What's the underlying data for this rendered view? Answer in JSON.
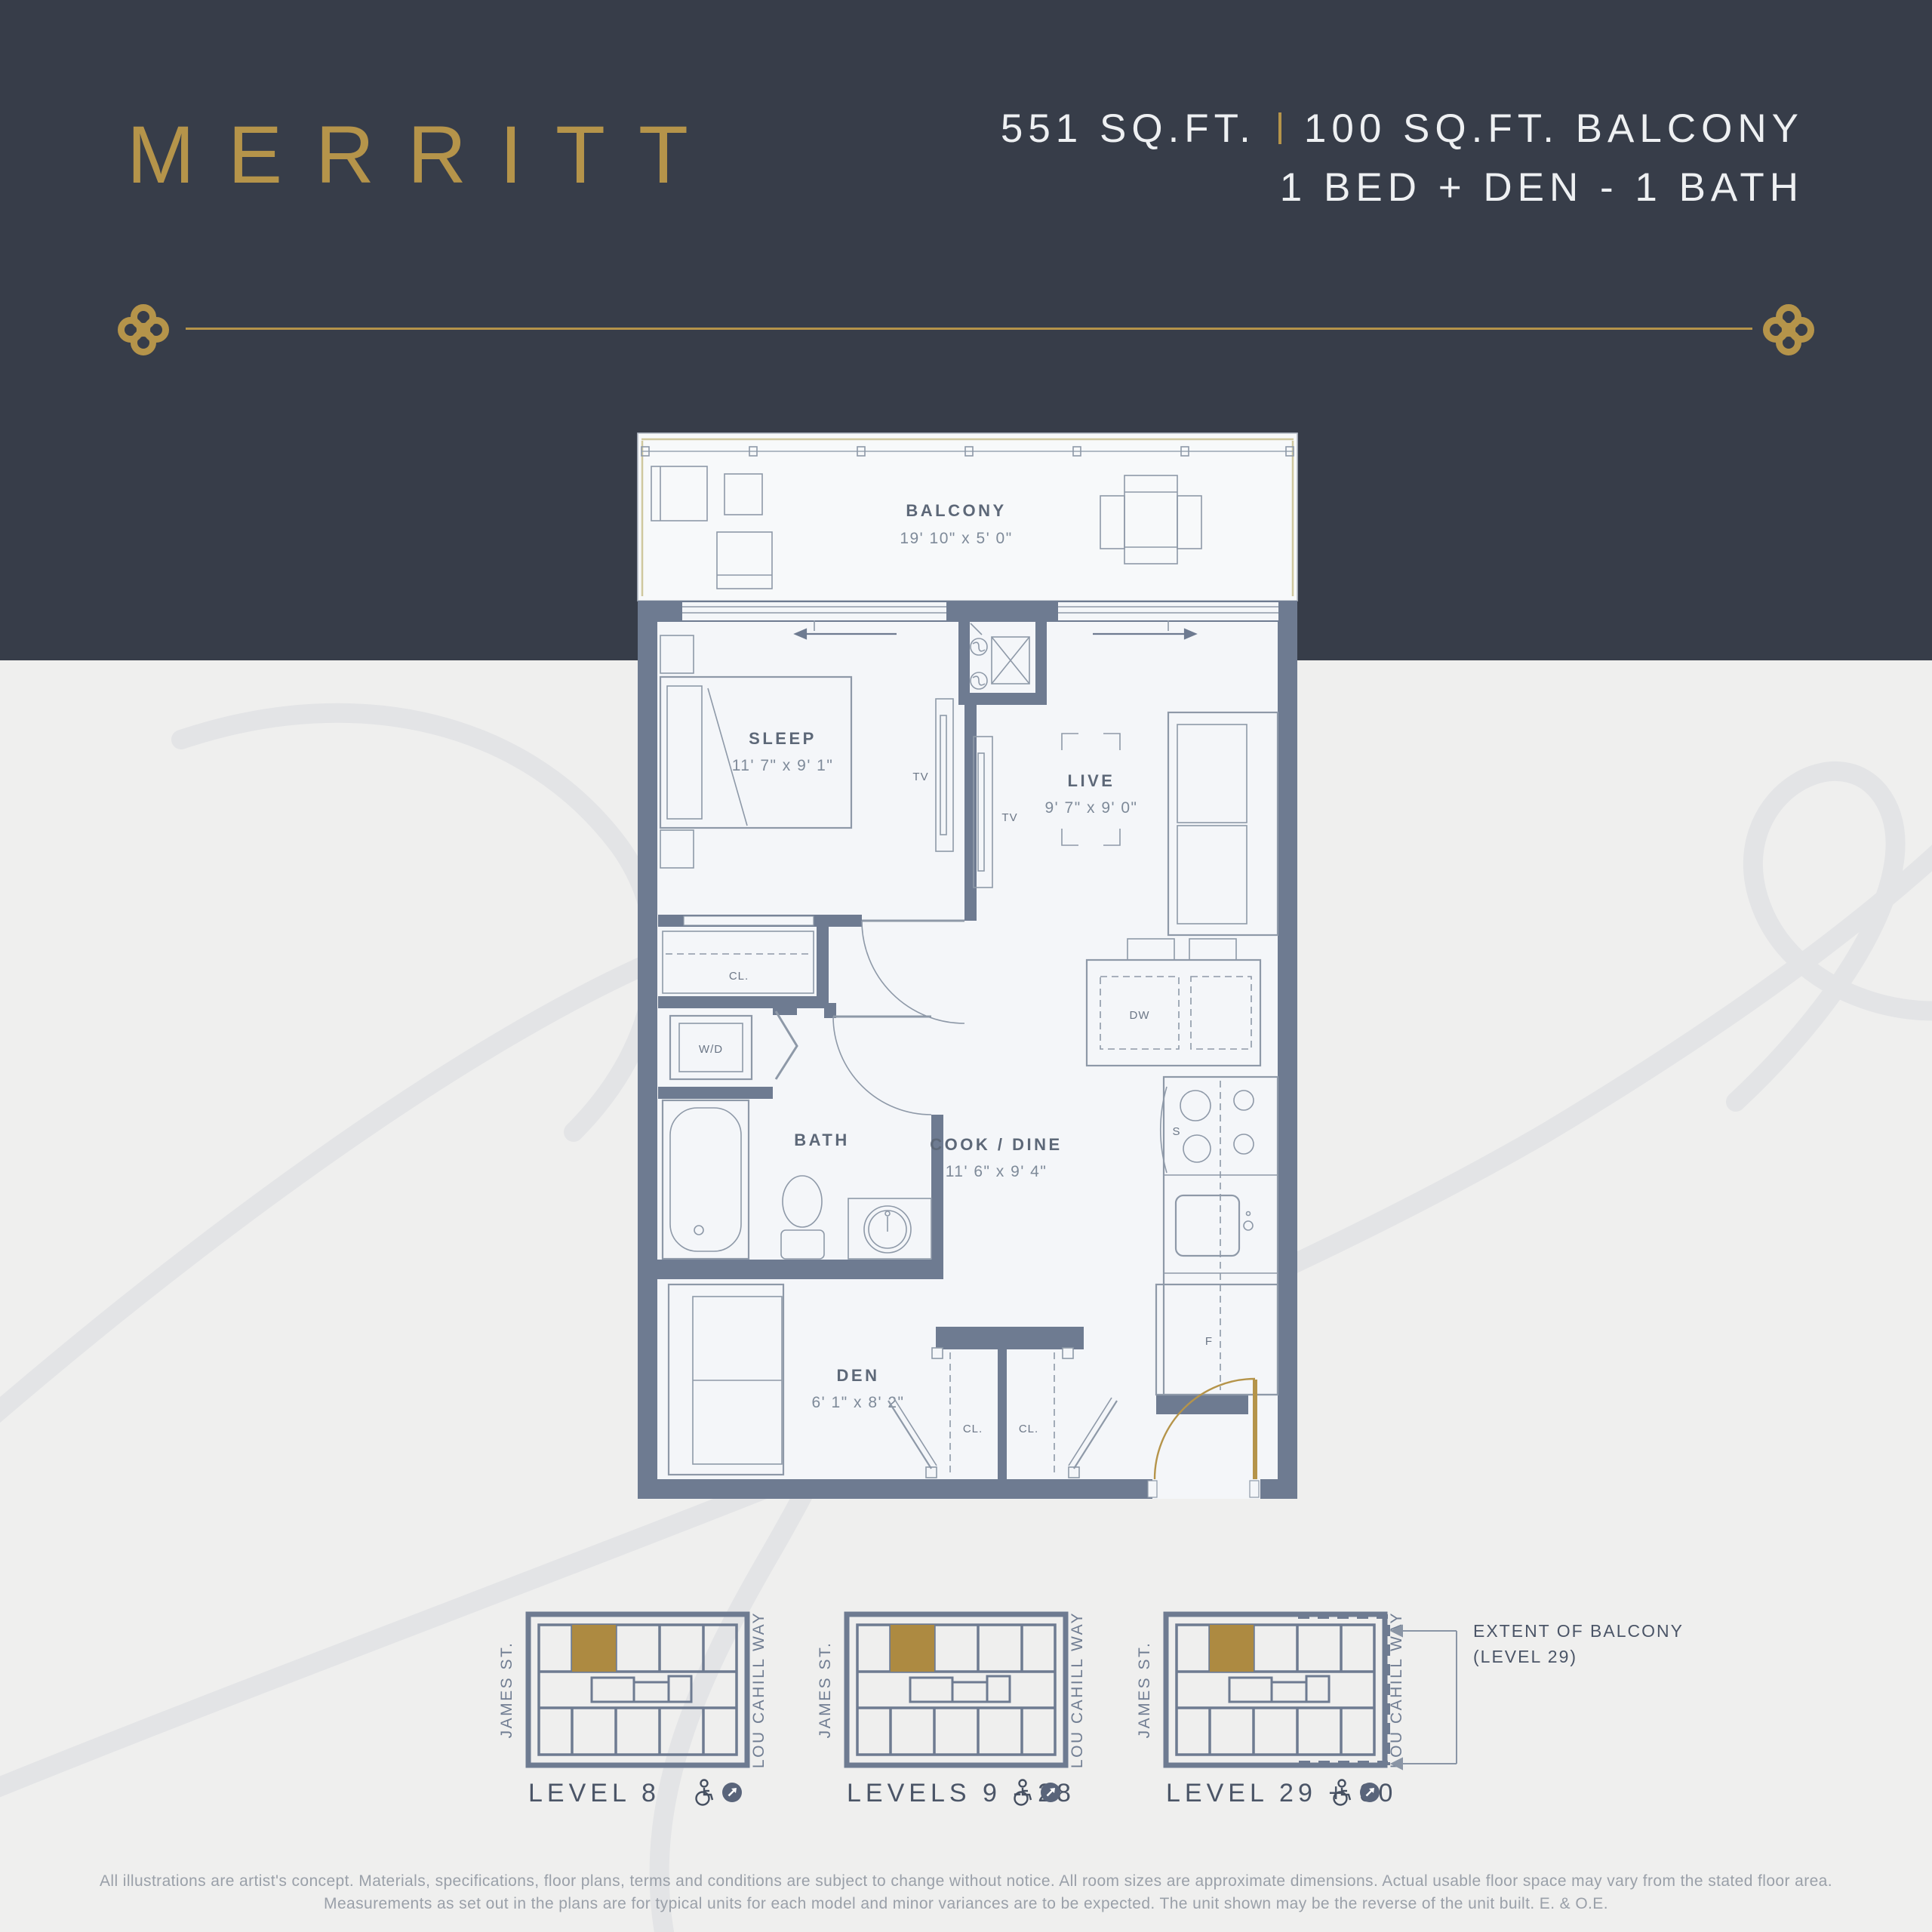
{
  "header": {
    "unit_name": "MERRITT",
    "area_sqft": "551 SQ.FT.",
    "balcony_sqft": "100 SQ.FT. BALCONY",
    "configuration": "1 BED + DEN - 1 BATH",
    "colors": {
      "gold": "#b5944a",
      "navy": "#373d49"
    }
  },
  "floorplan": {
    "rooms": {
      "balcony": {
        "name": "BALCONY",
        "dims": "19' 10\" x 5' 0\""
      },
      "sleep": {
        "name": "SLEEP",
        "dims": "11' 7\" x 9' 1\""
      },
      "live": {
        "name": "LIVE",
        "dims": "9' 7\" x 9' 0\""
      },
      "cook_dine": {
        "name": "COOK / DINE",
        "dims": "11' 6\" x 9' 4\""
      },
      "bath": {
        "name": "BATH"
      },
      "den": {
        "name": "DEN",
        "dims": "6' 1\" x 8' 2\""
      }
    },
    "fixtures": {
      "tv1": "TV",
      "tv2": "TV",
      "washer_dryer": "W/D",
      "closet1": "CL.",
      "closet2": "CL.",
      "closet3": "CL.",
      "dishwasher": "DW",
      "stove": "S",
      "fridge": "F"
    }
  },
  "keyplans": {
    "street_left": "JAMES ST.",
    "street_right": "LOU CAHILL WAY",
    "plans": [
      {
        "label": "LEVEL 8"
      },
      {
        "label": "LEVELS 9 - 28"
      },
      {
        "label": "LEVEL 29 + 30"
      }
    ],
    "balcony_note_line1": "EXTENT OF BALCONY",
    "balcony_note_line2": "(LEVEL 29)"
  },
  "disclaimer": {
    "line1": "All illustrations are artist's concept. Materials, specifications, floor plans, terms and conditions are subject to change without notice. All room sizes are approximate dimensions. Actual usable floor space may vary from the stated floor area.",
    "line2": "Measurements as set out in the plans are for typical units for each model and minor variances are to be expected. The unit shown may be the reverse of the unit built. E. & O.E."
  }
}
